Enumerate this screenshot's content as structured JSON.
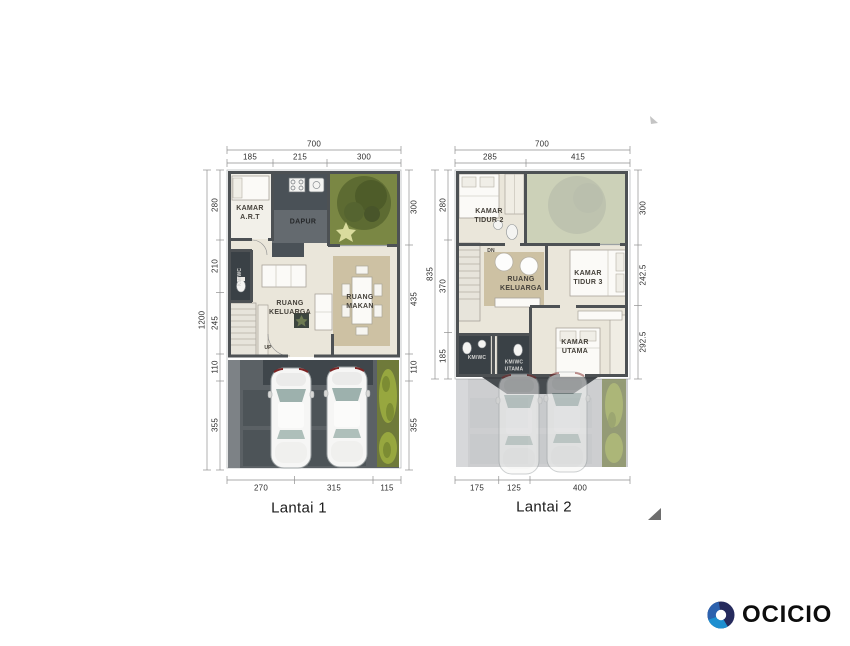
{
  "lantai1": {
    "title": "Lantai 1",
    "dim_total_width": "700",
    "dim_total_height": "1200",
    "dims_top": [
      "185",
      "215",
      "300"
    ],
    "dims_left": [
      "280",
      "210",
      "245",
      "110",
      "355"
    ],
    "dims_right": [
      "300",
      "435",
      "110",
      "355"
    ],
    "dims_bottom": [
      "270",
      "315",
      "115"
    ],
    "rooms": {
      "kamar_art": "KAMAR\nA.R.T",
      "dapur": "DAPUR",
      "km_wc": "KM/WC",
      "ruang_keluarga": "RUANG\nKELUARGA",
      "ruang_makan": "RUANG\nMAKAN",
      "stair_direction": "UP"
    }
  },
  "lantai2": {
    "title": "Lantai 2",
    "dim_total_width": "700",
    "dim_total_height": "835",
    "dims_top": [
      "285",
      "415"
    ],
    "dims_left": [
      "280",
      "370",
      "185"
    ],
    "dims_right": [
      "300",
      "242.5",
      "292.5"
    ],
    "dims_bottom": [
      "175",
      "125",
      "400"
    ],
    "rooms": {
      "kamar_tidur_2": "KAMAR\nTIDUR 2",
      "ruang_keluarga": "RUANG\nKELUARGA",
      "kamar_tidur_3": "KAMAR\nTIDUR 3",
      "kamar_utama": "KAMAR\nUTAMA",
      "km_wc": "KM/WC",
      "km_wc_utama": "KM/WC\nUTAMA",
      "stair_direction": "DN"
    }
  },
  "branding": {
    "name": "OCICIO"
  },
  "colors": {
    "logo_navy": "#262b5d",
    "logo_blue": "#1e8fd0",
    "logo_mid_blue": "#2d62ae",
    "garden_green": "#7a8744",
    "tree_green": "#55632e",
    "floor_beige": "#eae6da",
    "tile_dark": "#41474d",
    "paving_gray": "#5b6165",
    "rug_tan": "#cdc1a3",
    "wall_gray": "#4d5154"
  }
}
